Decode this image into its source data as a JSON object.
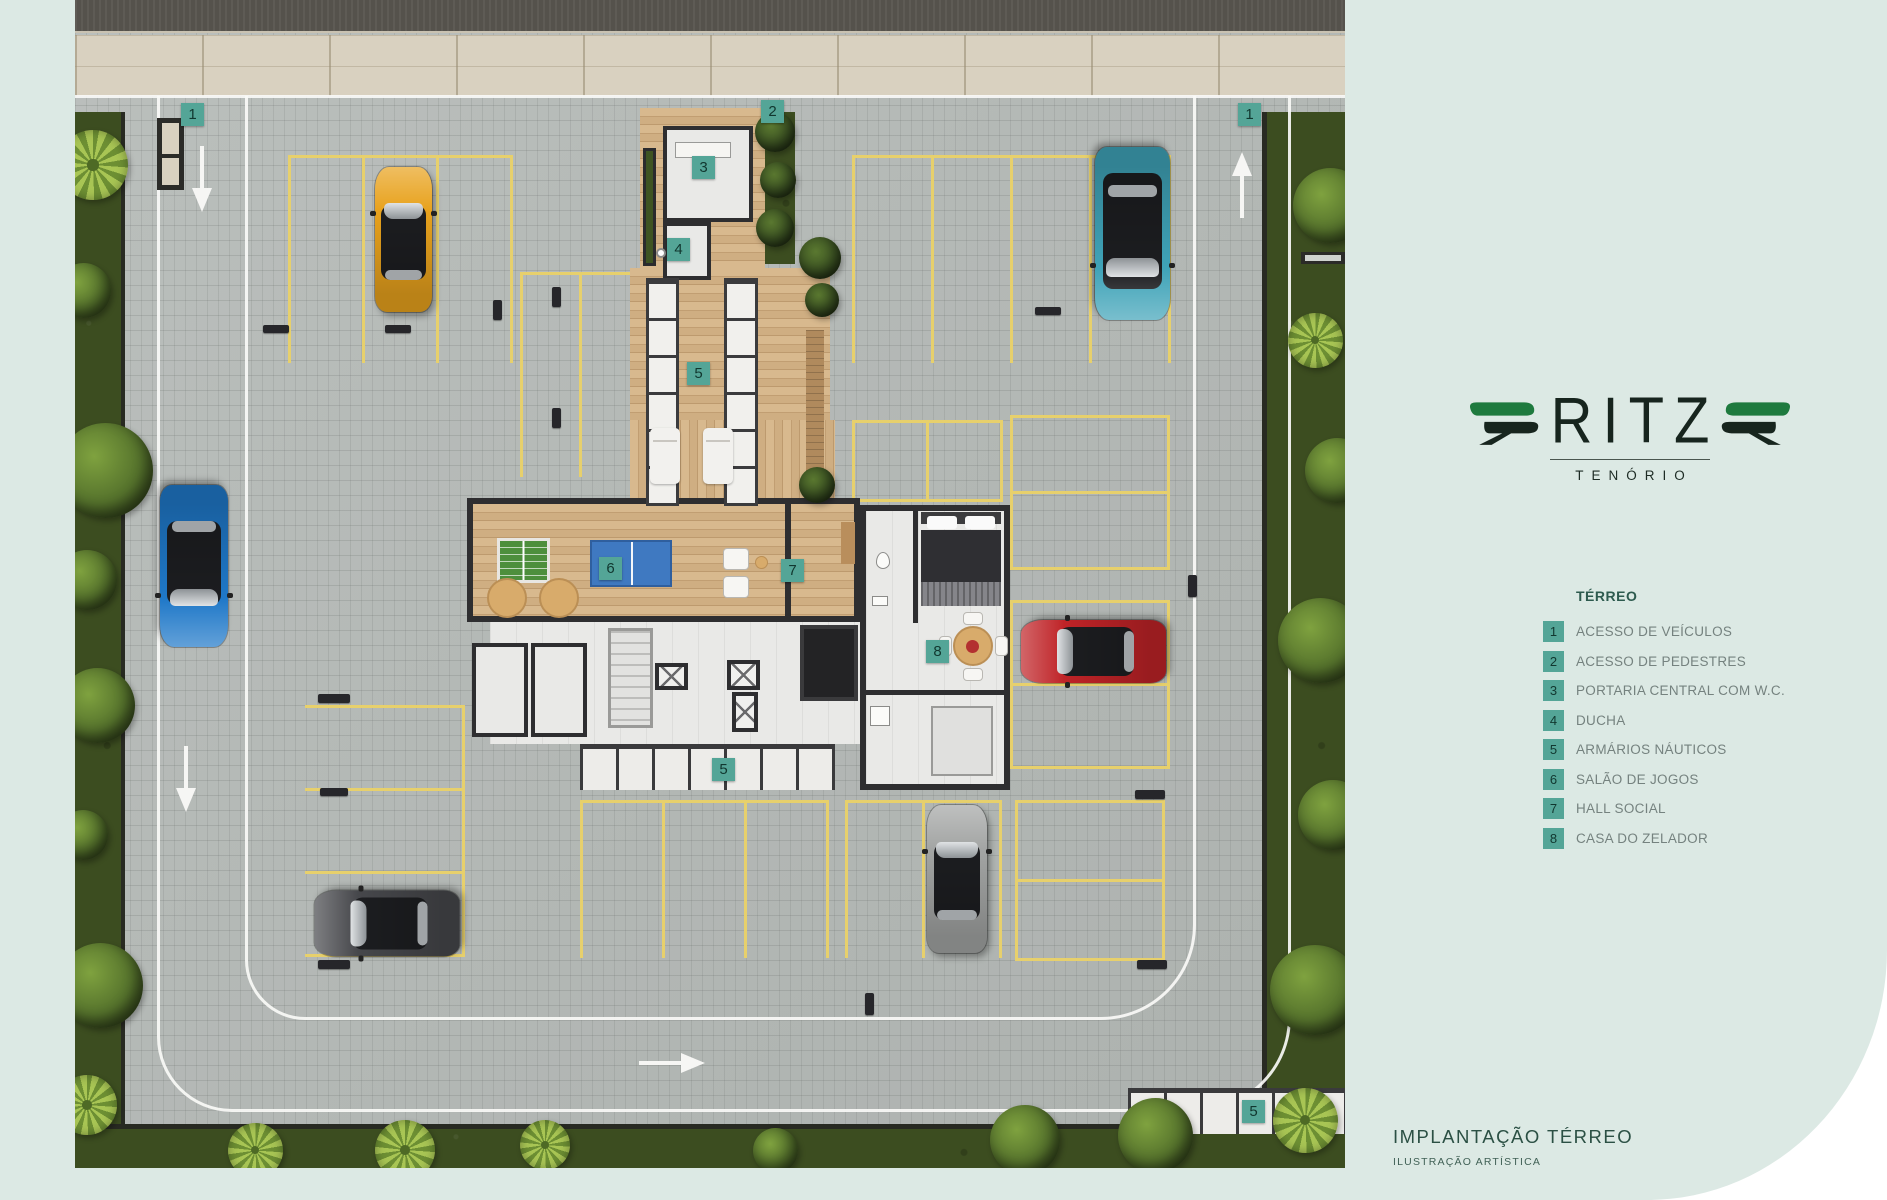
{
  "logo": {
    "brand": "RITZ",
    "subbrand": "TENÓRIO"
  },
  "legend": {
    "title": "TÉRREO",
    "items": [
      {
        "num": "1",
        "label": "ACESSO DE VEÍCULOS"
      },
      {
        "num": "2",
        "label": "ACESSO DE PEDESTRES"
      },
      {
        "num": "3",
        "label": "PORTARIA CENTRAL COM W.C."
      },
      {
        "num": "4",
        "label": "DUCHA"
      },
      {
        "num": "5",
        "label": "ARMÁRIOS NÁUTICOS"
      },
      {
        "num": "6",
        "label": "SALÃO DE JOGOS"
      },
      {
        "num": "7",
        "label": "HALL SOCIAL"
      },
      {
        "num": "8",
        "label": "CASA DO ZELADOR"
      }
    ]
  },
  "footer": {
    "title": "IMPLANTAÇÃO TÉRREO",
    "subtitle": "ILUSTRAÇÃO ARTÍSTICA"
  },
  "plan": {
    "marker_numbers": [
      "1",
      "1",
      "2",
      "3",
      "4",
      "5",
      "5",
      "5",
      "6",
      "7",
      "8"
    ]
  },
  "colors": {
    "background_mint": "#dce9e4",
    "accent_teal": "#54a597",
    "marker_number": "#11372f",
    "legend_text": "#75827f",
    "heading_teal": "#2d5a4e",
    "logo_green": "#1e7a3e",
    "logo_dark": "#17251e",
    "stall_yellow": "#e7d06c",
    "car_orange": "#e8a21d",
    "car_teal": "#3fa3b8",
    "car_blue": "#1f78c8",
    "car_red": "#bf2327",
    "car_dark_gray": "#46474b",
    "car_silver": "#a3a5a4"
  }
}
